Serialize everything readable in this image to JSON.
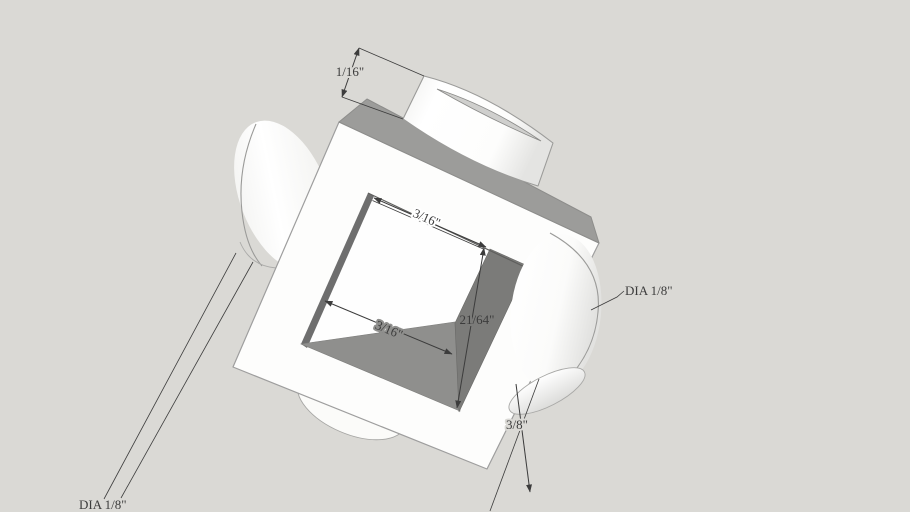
{
  "scene": {
    "type": "3d-model-viewport",
    "description": "White block with square through-hole and cylindrical bosses, shown with dimensions",
    "background_color": "#DAD9D5",
    "model": {
      "front_face_color": "#FDFDFC",
      "top_face_color": "#9C9C9A",
      "hole_floor_color": "#8F8F8D",
      "hole_right_wall_color": "#7B7B79",
      "hole_left_sliver_color": "#6E6E6E",
      "edge_color": "#9E9E9E",
      "profile_edge_color": "#5F5F5F",
      "annotation_color": "#3C3C3C"
    },
    "dimensions": [
      {
        "id": "dim_boss_height",
        "label": "1/16\""
      },
      {
        "id": "dim_hole_width_top",
        "label": "3/16\""
      },
      {
        "id": "dim_hole_width_floor",
        "label": "3/16\""
      },
      {
        "id": "dim_hole_depth",
        "label": "21/64\""
      },
      {
        "id": "leader_dia_right",
        "label": "DIA 1/8\""
      },
      {
        "id": "dim_boss_length",
        "label": "3/8\""
      },
      {
        "id": "leader_dia_left",
        "label": "DIA 1/8\""
      }
    ]
  }
}
